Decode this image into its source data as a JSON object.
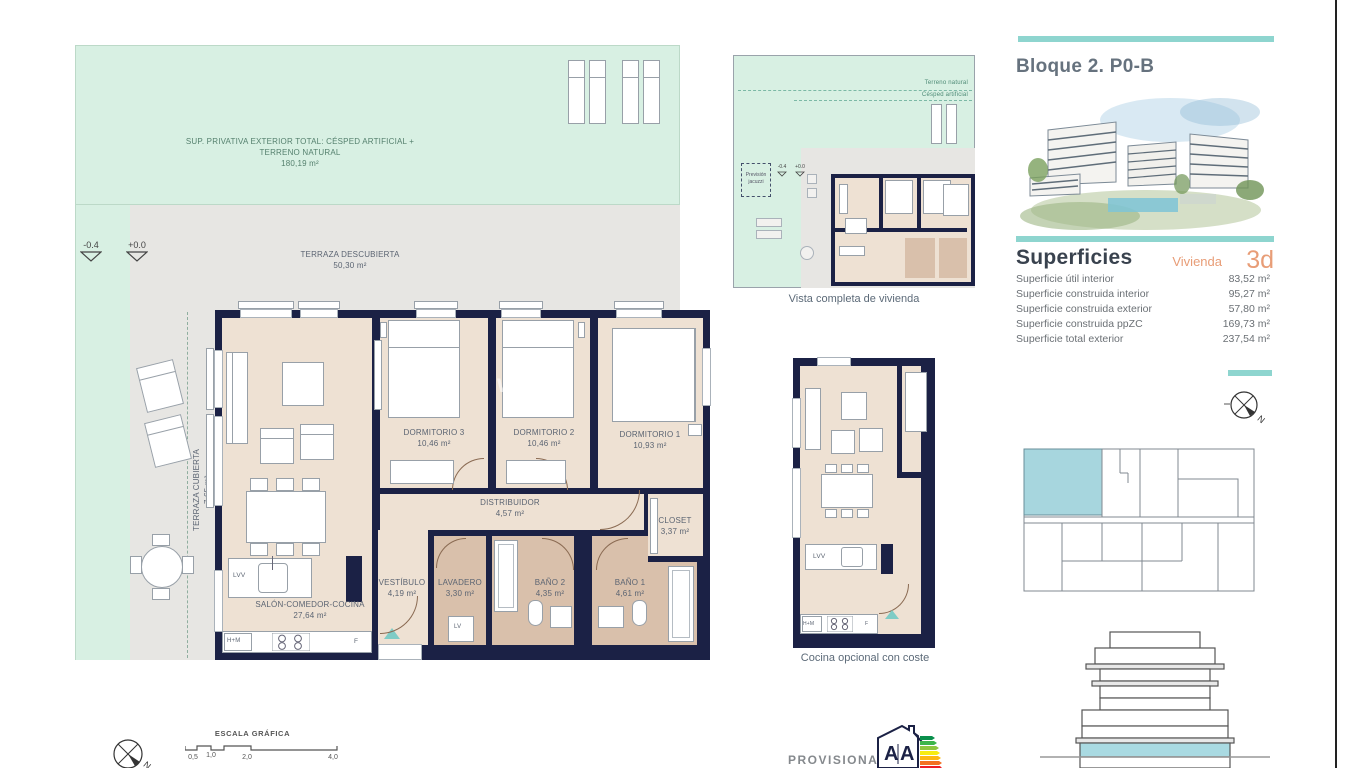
{
  "page": {
    "watermark_prefix": "www",
    "watermark_suffix": "s"
  },
  "plan": {
    "exterior": {
      "lawn_label": "SUP. PRIVATIVA EXTERIOR TOTAL: CÉSPED ARTIFICIAL + TERRENO NATURAL",
      "lawn_area": "180,19 m²",
      "terraza_descubierta_label": "TERRAZA DESCUBIERTA",
      "terraza_descubierta_area": "50,30 m²",
      "terraza_cubierta_label": "TERRAZA CUBIERTA",
      "terraza_cubierta_area": "7,65 m²",
      "level_low": "-0.4",
      "level_zero": "+0.0"
    },
    "rooms": {
      "salon": {
        "name": "SALÓN-COMEDOR-COCINA",
        "area": "27,64 m²"
      },
      "dorm3": {
        "name": "DORMITORIO 3",
        "area": "10,46 m²"
      },
      "dorm2": {
        "name": "DORMITORIO 2",
        "area": "10,46 m²"
      },
      "dorm1": {
        "name": "DORMITORIO 1",
        "area": "10,93 m²"
      },
      "distribuidor": {
        "name": "DISTRIBUIDOR",
        "area": "4,57 m²"
      },
      "closet": {
        "name": "CLOSET",
        "area": "3,37 m²"
      },
      "vestibulo": {
        "name": "VESTÍBULO",
        "area": "4,19 m²"
      },
      "lavadero": {
        "name": "LAVADERO",
        "area": "3,30 m²"
      },
      "bano2": {
        "name": "BAÑO 2",
        "area": "4,35 m²"
      },
      "bano1": {
        "name": "BAÑO 1",
        "area": "4,61 m²"
      }
    },
    "appliances": {
      "lvv": "LVV",
      "lv": "LV",
      "hm": "H+M",
      "f": "F"
    }
  },
  "mini_plan": {
    "caption": "Vista completa de vivienda",
    "terrain_label1": "Terreno natural",
    "terrain_label2": "Césped artificial",
    "provision_label": "Previsión jacuzzi",
    "level_low": "-0.4",
    "level_zero": "+0.0"
  },
  "cocina_plan": {
    "caption": "Cocina opcional con coste",
    "lvv": "LVV",
    "hm": "H+M",
    "f": "F"
  },
  "sidebar": {
    "title": "Bloque 2. P0-B",
    "superficies": {
      "heading": "Superficies",
      "unit_label": "Vivienda",
      "unit_value": "3d",
      "rows": [
        {
          "label": "Superficie útil interior",
          "value": "83,52 m²"
        },
        {
          "label": "Superficie construida interior",
          "value": "95,27 m²"
        },
        {
          "label": "Superficie construida exterior",
          "value": "57,80 m²"
        },
        {
          "label": "Superficie construida ppZC",
          "value": "169,73 m²"
        },
        {
          "label": "Superficie total exterior",
          "value": "237,54 m²"
        }
      ]
    },
    "compass_label": "N"
  },
  "footer": {
    "scale_title": "ESCALA GRÁFICA",
    "scale_ticks": [
      "0,5",
      "1,0",
      "2,0",
      "4,0"
    ],
    "compass_label": "N",
    "provisional": "PROVISIONAL",
    "energy": {
      "letter1": "A",
      "letter2": "A"
    }
  },
  "colors": {
    "wall": "#1b2145",
    "lawn": "#d8f0e3",
    "terrace": "#e7e6e3",
    "floor": "#eee1d3",
    "wet": "#d9c0ab",
    "teal": "#8ed5cf",
    "accent_orange": "#e89d77",
    "key_highlight": "#a7d6de"
  }
}
